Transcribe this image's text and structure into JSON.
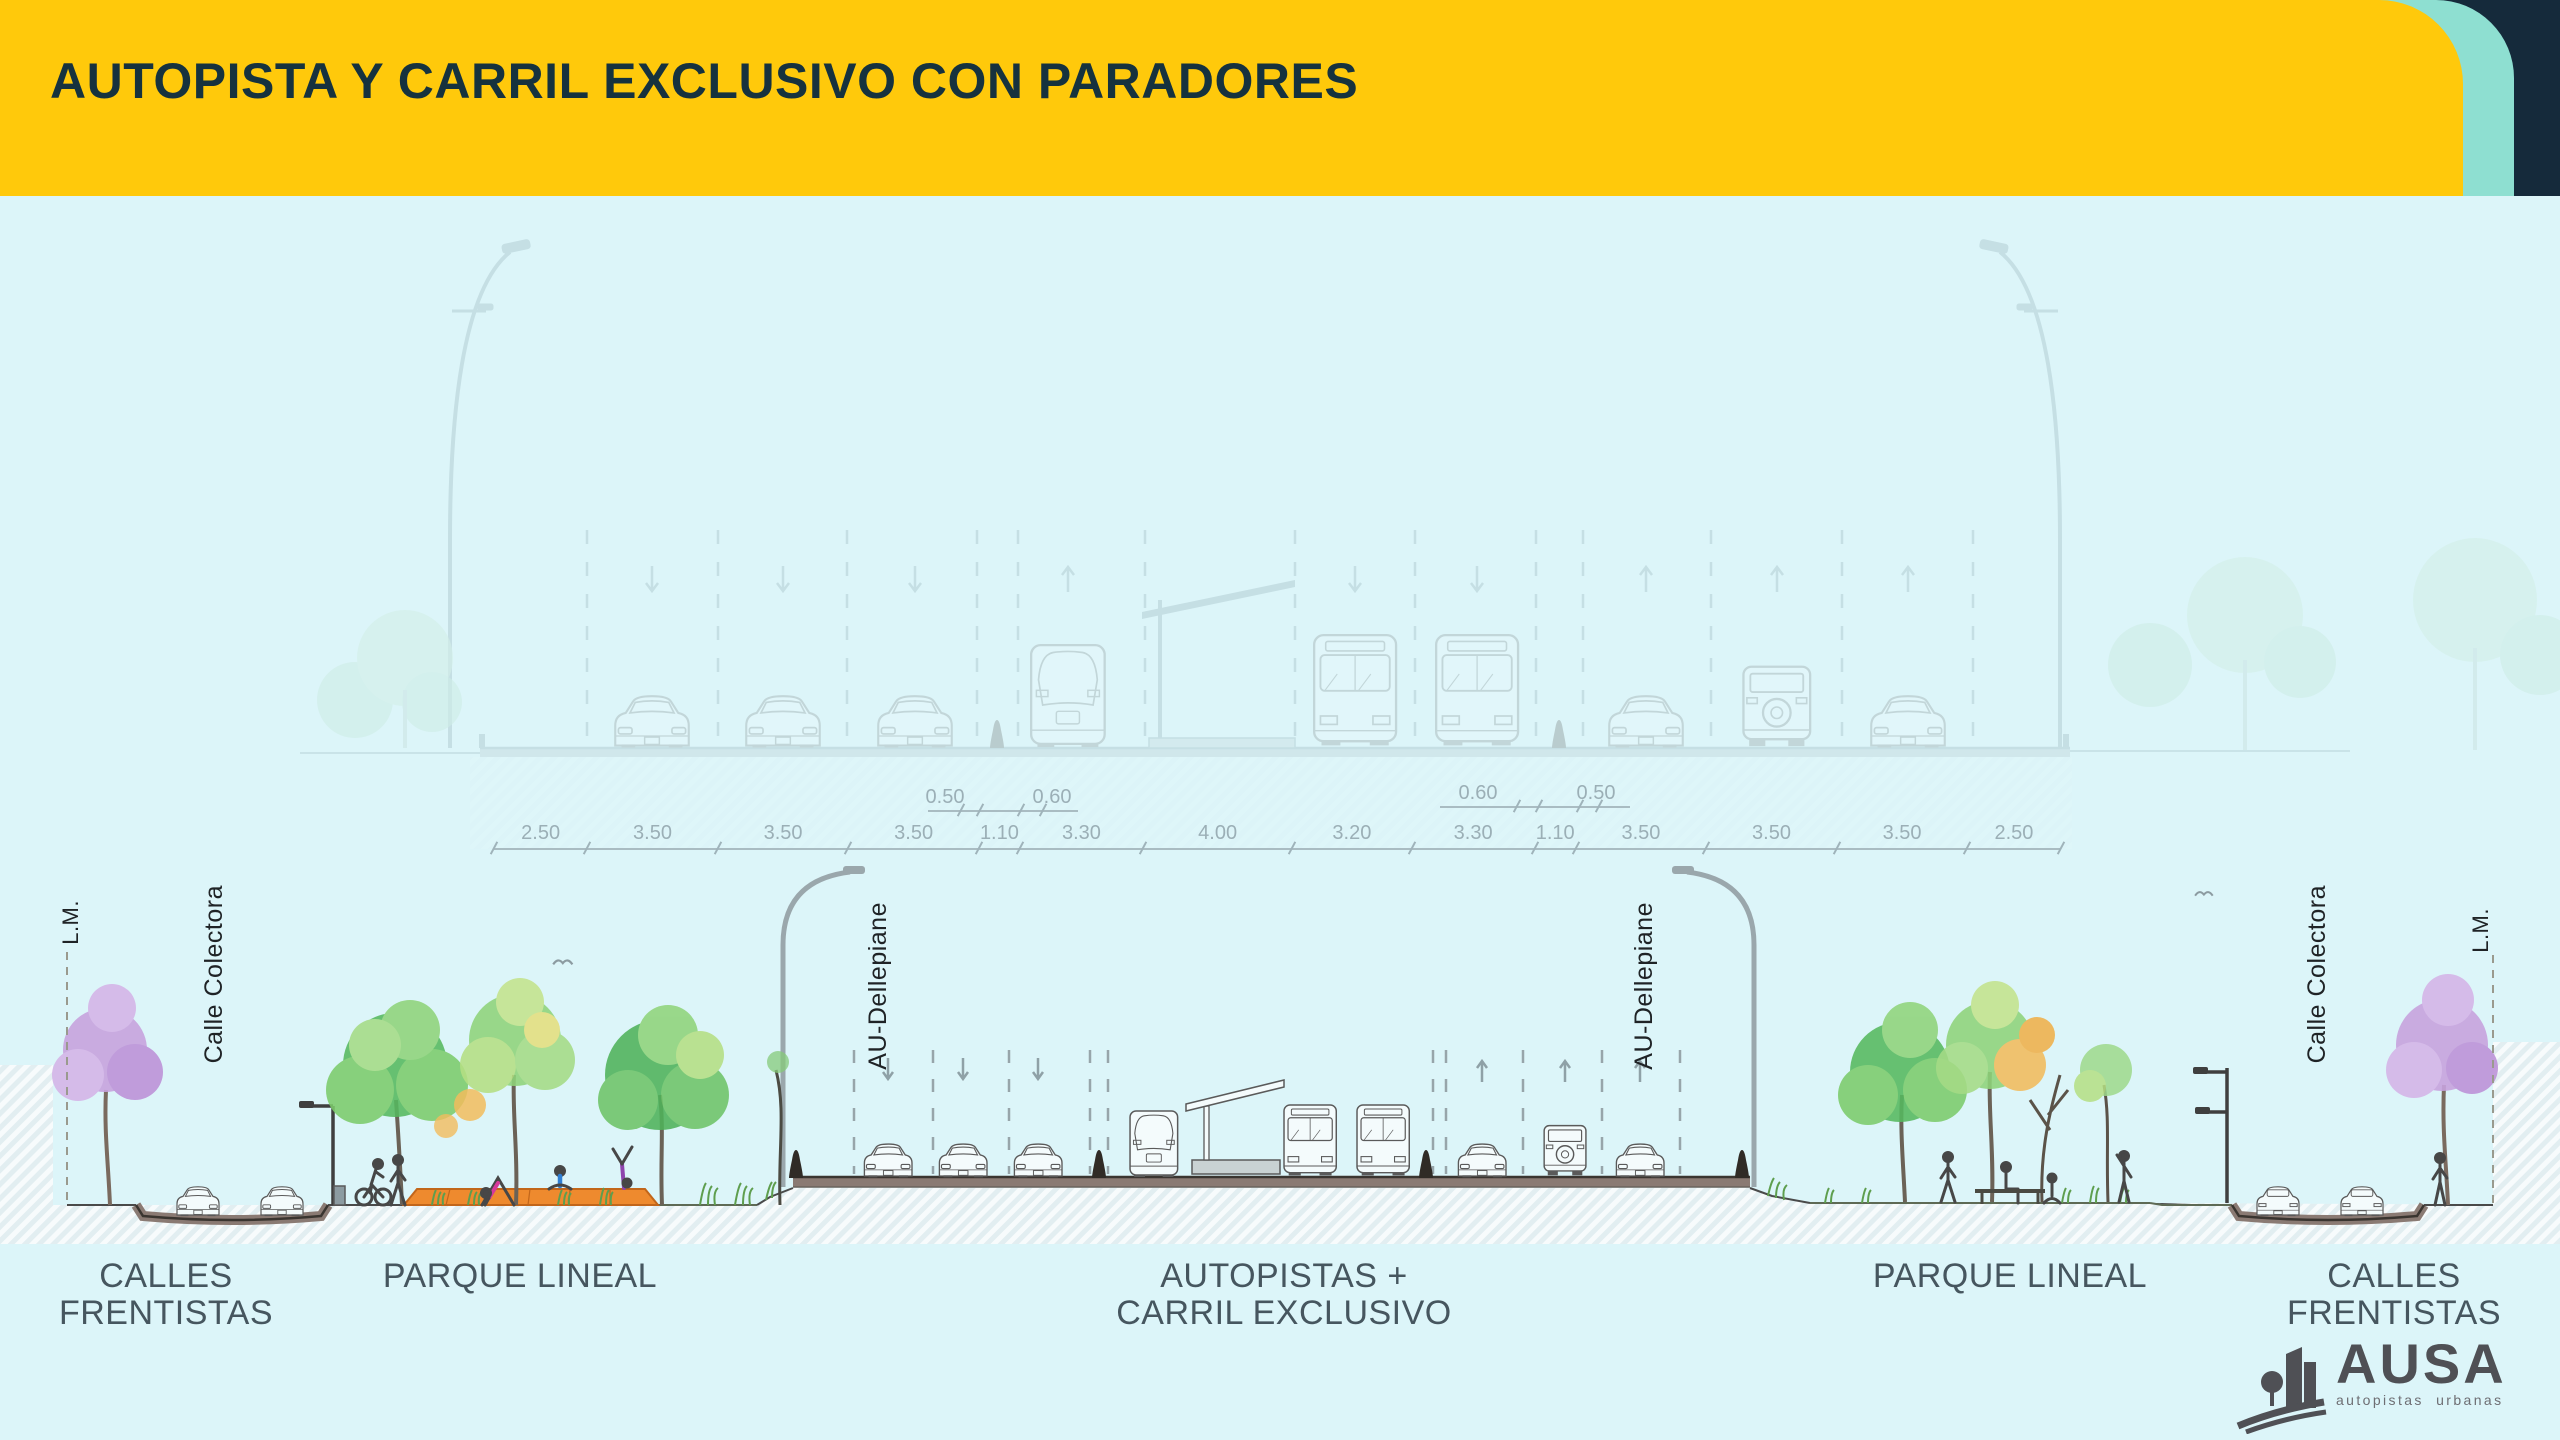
{
  "header": {
    "title": "AUTOPISTA Y CARRIL EXCLUSIVO CON PARADORES"
  },
  "theme": {
    "header_yellow": "#FFC90B",
    "accent_mint": "#8EDFD1",
    "accent_navy": "#152A3B",
    "background": "#DCF5F9",
    "title_color": "#16323E",
    "zone_label_color": "#46565F",
    "dimension_color": "#9BAFB6",
    "road_fill": "#8A7A73",
    "deck_orange": "#EE8A2E",
    "tree_purple": "#C7A3DE",
    "logo_gray": "#4F5055"
  },
  "top_section": {
    "dimensions_m": [
      "2.50",
      "3.50",
      "3.50",
      "3.50",
      "1.10",
      "3.30",
      "4.00",
      "3.20",
      "3.30",
      "1.10",
      "3.50",
      "3.50",
      "3.50",
      "2.50"
    ],
    "sub_dimensions_left": [
      "0.50",
      "0.60"
    ],
    "sub_dimensions_right": [
      "0.60",
      "0.50"
    ]
  },
  "cross_section": {
    "vertical_labels": [
      "L.M.",
      "Calle Colectora",
      "AU-Dellepiane",
      "AU-Dellepiane",
      "Calle Colectora",
      "L.M."
    ],
    "zone_labels": [
      {
        "lines": [
          "CALLES",
          "FRENTISTAS"
        ]
      },
      {
        "lines": [
          "PARQUE LINEAL"
        ]
      },
      {
        "lines": [
          "AUTOPISTAS +",
          "CARRIL EXCLUSIVO"
        ]
      },
      {
        "lines": [
          "PARQUE LINEAL"
        ]
      },
      {
        "lines": [
          "CALLES",
          "FRENTISTAS"
        ]
      }
    ]
  },
  "logo": {
    "name": "AUSA",
    "tagline": "autopistas urbanas"
  }
}
